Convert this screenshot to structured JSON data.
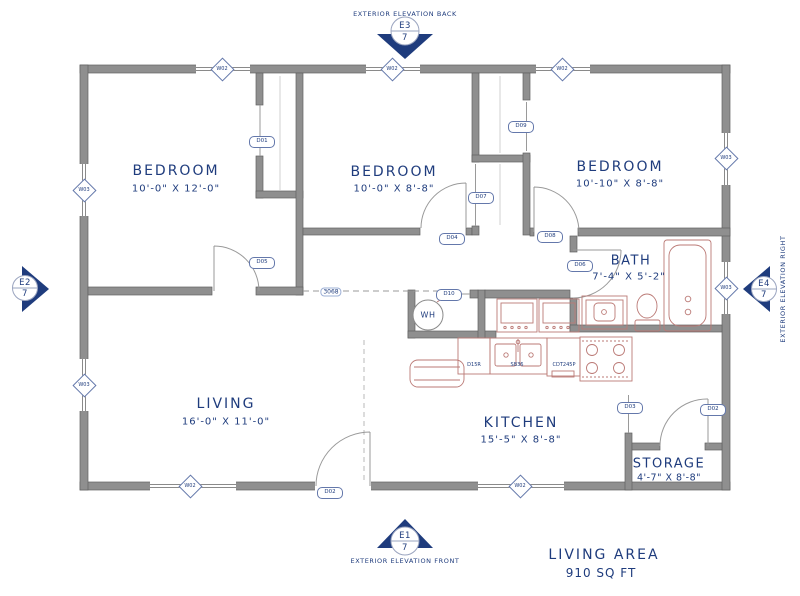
{
  "colors": {
    "ink": "#1f3c7d",
    "wall": "#8f8f8f",
    "fixture": "#bb7a76"
  },
  "rooms": [
    {
      "name": "BEDROOM",
      "dims": "10'-0\" X 12'-0\""
    },
    {
      "name": "BEDROOM",
      "dims": "10'-0\" X 8'-8\""
    },
    {
      "name": "BEDROOM",
      "dims": "10'-10\" X 8'-8\""
    },
    {
      "name": "BATH",
      "dims": "7'-4\" X 5'-2\""
    },
    {
      "name": "LIVING",
      "dims": "16'-0\" X 11'-0\""
    },
    {
      "name": "KITCHEN",
      "dims": "15'-5\" X 8'-8\""
    },
    {
      "name": "STORAGE",
      "dims": "4'-7\" X 8'-8\""
    }
  ],
  "area_summary": {
    "title": "LIVING AREA",
    "value": "910 SQ FT"
  },
  "elevations": {
    "back": {
      "id": "E3",
      "sheet": "7",
      "label": "EXTERIOR ELEVATION BACK"
    },
    "front": {
      "id": "E1",
      "sheet": "7",
      "label": "EXTERIOR ELEVATION FRONT"
    },
    "left": {
      "id": "E2",
      "sheet": "7"
    },
    "right": {
      "id": "E4",
      "sheet": "7",
      "label": "EXTERIOR ELEVATION RIGHT"
    }
  },
  "annotations": {
    "opening": "3068",
    "water_heater": "WH"
  },
  "cabinet_labels": [
    {
      "label": "D15R"
    },
    {
      "label": "SB36"
    },
    {
      "label": "CDT245P"
    }
  ],
  "door_tags": [
    {
      "label": "D01"
    },
    {
      "label": "D05"
    },
    {
      "label": "D04"
    },
    {
      "label": "D07"
    },
    {
      "label": "D09"
    },
    {
      "label": "D08"
    },
    {
      "label": "D06"
    },
    {
      "label": "D10"
    },
    {
      "label": "D02"
    },
    {
      "label": "D03"
    },
    {
      "label": "D02"
    }
  ],
  "window_tags": [
    {
      "label": "W02"
    },
    {
      "label": "W02"
    },
    {
      "label": "W02"
    },
    {
      "label": "W03"
    },
    {
      "label": "W03"
    },
    {
      "label": "W03"
    },
    {
      "label": "W03"
    },
    {
      "label": "W02"
    },
    {
      "label": "W02"
    }
  ]
}
